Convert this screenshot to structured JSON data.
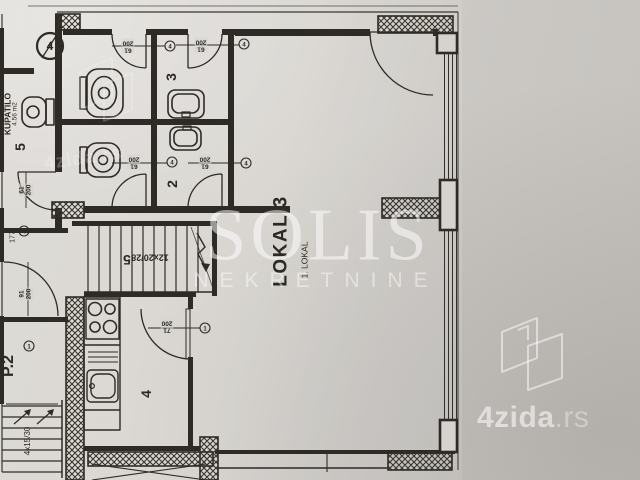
{
  "colors": {
    "paper": "#d6d3ce",
    "ink": "#2e2b26",
    "watermark": "#ffffff"
  },
  "watermarks": {
    "solis": "SOLIS",
    "solis_sub": "NEKRETNINE",
    "brand": "4zida",
    "brand_tld": ".rs",
    "brand_diagonal": "4zida.rs"
  },
  "rooms": {
    "bathroom_name": "KUPATILO",
    "bathroom_area": "4.56 m2",
    "bathroom_no": "5",
    "wc3": "3",
    "wc2": "2",
    "kitchen": "4",
    "hall": "P.2",
    "stair_no": "5",
    "lokal_title": "LOKAL 3",
    "lokal_unit": "1. LOKAL"
  },
  "stairs": {
    "main": "12x20/28",
    "side": "4x15/30"
  },
  "dims": {
    "d177": "177",
    "wc_a": {
      "w": "61",
      "h": "200"
    },
    "wc_3": {
      "w": "61",
      "h": "200"
    },
    "wc_b": {
      "w": "61",
      "h": "200"
    },
    "wc_2": {
      "w": "61",
      "h": "200"
    },
    "bath": {
      "w": "61",
      "h": "200"
    },
    "hall": {
      "w": "91",
      "h": "200"
    },
    "kitchen": {
      "w": "71",
      "h": "200"
    }
  },
  "markers": {
    "big": "4",
    "wc_a": "4",
    "wc_3": "4",
    "wc_b": "4",
    "wc_2": "4",
    "kitchen": "1",
    "hall_top": "4",
    "hall_bottom": "1"
  }
}
